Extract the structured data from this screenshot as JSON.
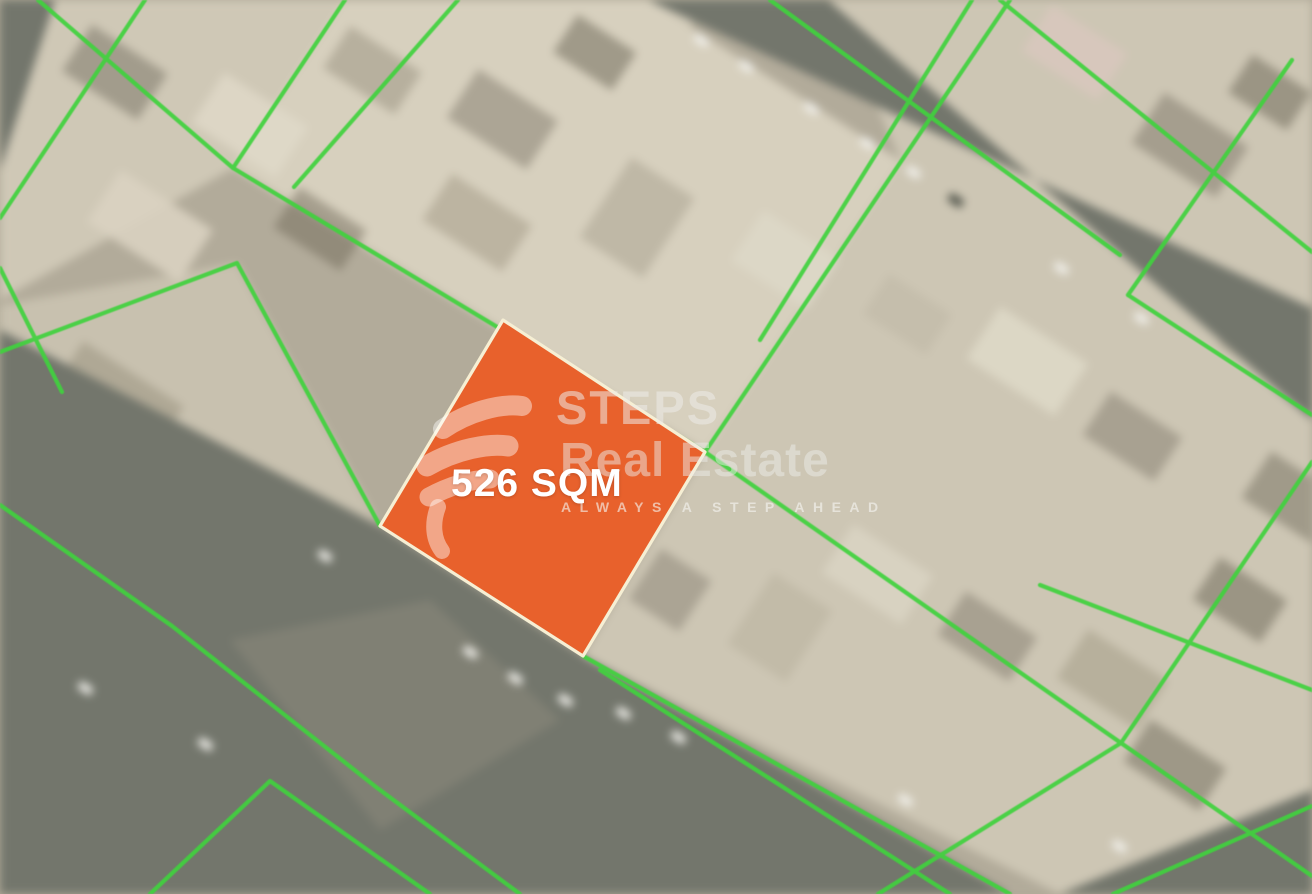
{
  "map": {
    "ground_color": "#b2ab9a",
    "block_color": "#cec7b5",
    "road_color": "#73766c",
    "boundary_color": "#40d23e",
    "plot": {
      "area_label": "526 SQM",
      "fill_color": "#e8612c",
      "border_color": "#f6efd4"
    },
    "watermark": {
      "brand_line1": "STEPS",
      "brand_line2": "Real Estate",
      "tagline": "ALWAYS A STEP AHEAD",
      "logo_icon": "steps-swoosh-logo",
      "text_color": "#e9e8e4"
    }
  }
}
